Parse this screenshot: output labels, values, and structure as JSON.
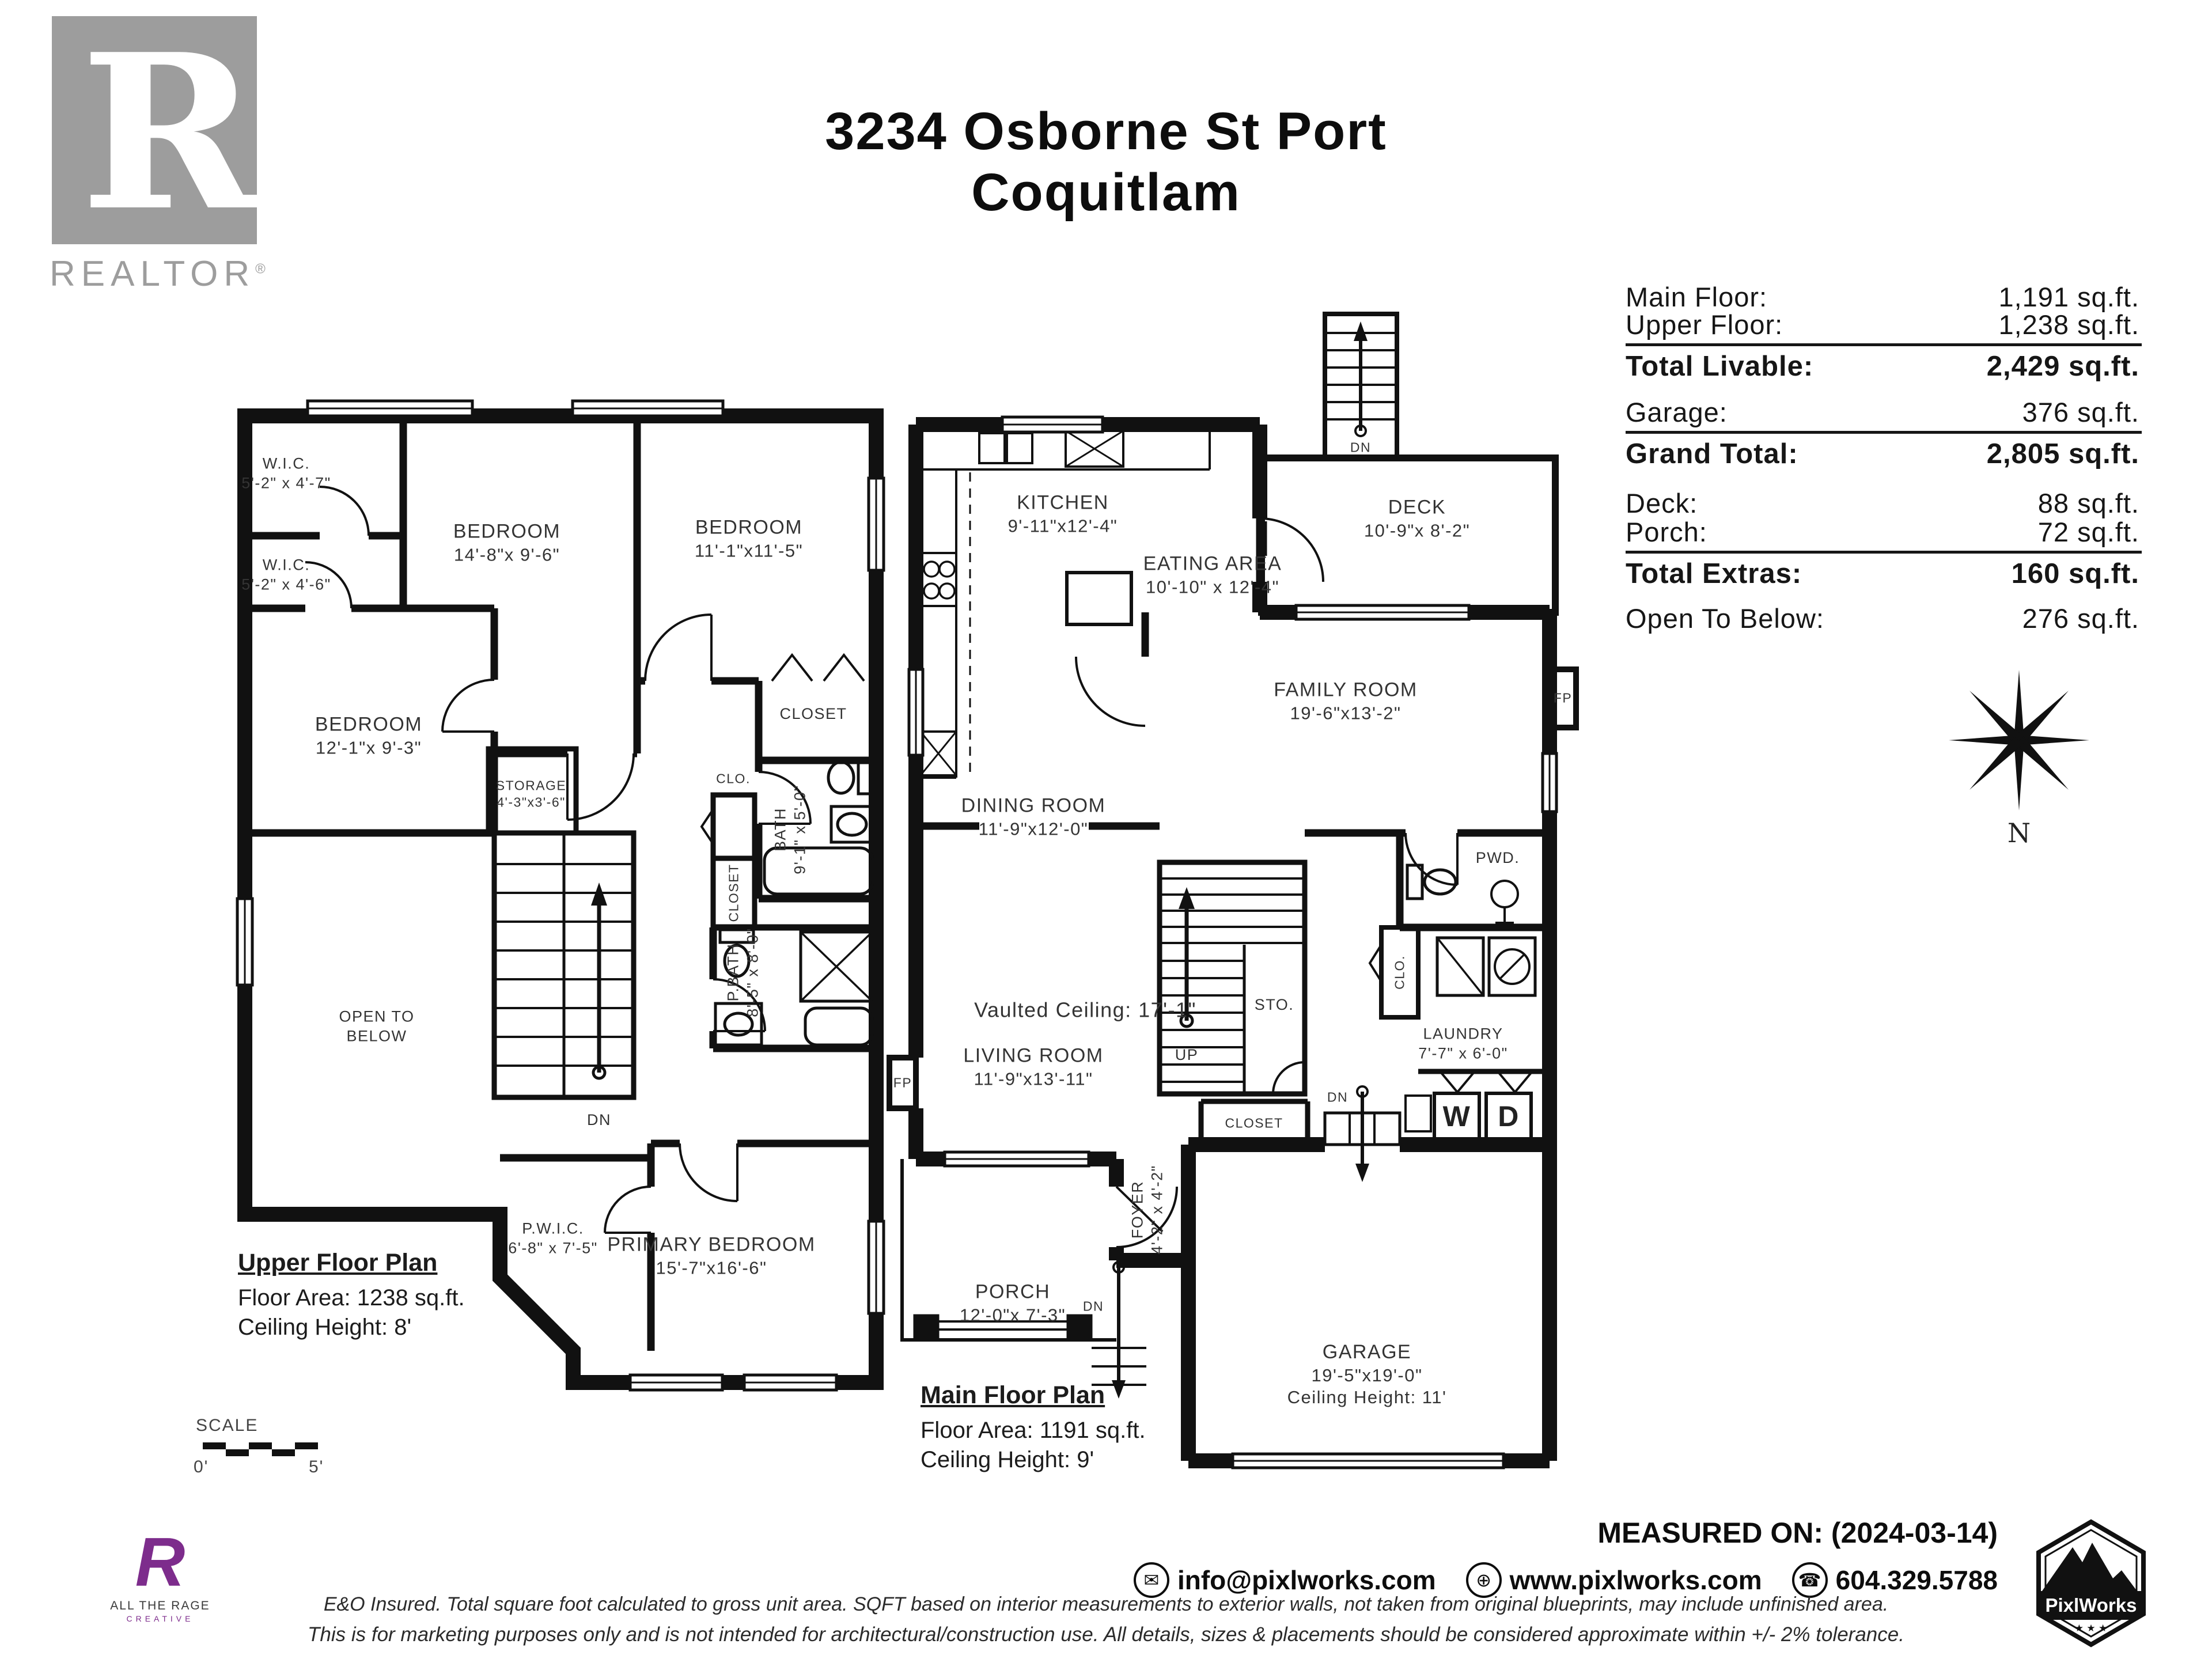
{
  "header": {
    "title_line1": "3234 Osborne St Port",
    "title_line2": "Coquitlam"
  },
  "realtor_logo": {
    "letter": "R",
    "wordmark": "REALTOR",
    "registered": "®"
  },
  "area_table": {
    "rows": [
      {
        "label": "Main Floor:",
        "value": "1,191 sq.ft."
      },
      {
        "label": "Upper Floor:",
        "value": "1,238 sq.ft."
      },
      {
        "label": "Total Livable:",
        "value": "2,429 sq.ft."
      },
      {
        "label": "Garage:",
        "value": "376 sq.ft."
      },
      {
        "label": "Grand Total:",
        "value": "2,805 sq.ft."
      },
      {
        "label": "Deck:",
        "value": "88 sq.ft."
      },
      {
        "label": "Porch:",
        "value": "72 sq.ft."
      },
      {
        "label": "Total Extras:",
        "value": "160 sq.ft."
      },
      {
        "label": "Open To Below:",
        "value": "276 sq.ft."
      }
    ]
  },
  "compass": {
    "north": "N"
  },
  "upper_plan": {
    "title": "Upper Floor Plan",
    "floor_area": "Floor Area: 1238 sq.ft.",
    "ceiling": "Ceiling Height: 8'",
    "rooms": [
      {
        "name": "W.I.C.",
        "dims": "5'-2\" x 4'-7\""
      },
      {
        "name": "BEDROOM",
        "dims": "14'-8\"x 9'-6\""
      },
      {
        "name": "BEDROOM",
        "dims": "11'-1\"x11'-5\""
      },
      {
        "name": "W.I.C.",
        "dims": "5'-2\" x 4'-6\""
      },
      {
        "name": "BEDROOM",
        "dims": "12'-1\"x 9'-3\""
      },
      {
        "name": "STORAGE",
        "dims": "4'-3\"x3'-6\""
      },
      {
        "name": "CLOSET"
      },
      {
        "name": "BATH",
        "dims": "9'-1\" x 5'-0\""
      },
      {
        "name": "CLO."
      },
      {
        "name": "CLOSET"
      },
      {
        "name": "OPEN TO",
        "dims": "BELOW"
      },
      {
        "name": "DN"
      },
      {
        "name": "P.BATH",
        "dims": "8'-5\" x 8'-0\""
      },
      {
        "name": "P.W.I.C.",
        "dims": "6'-8\" x 7'-5\""
      },
      {
        "name": "PRIMARY BEDROOM",
        "dims": "15'-7\"x16'-6\""
      }
    ]
  },
  "main_plan": {
    "title": "Main Floor Plan",
    "floor_area": "Floor Area: 1191 sq.ft.",
    "ceiling": "Ceiling Height: 9'",
    "rooms": [
      {
        "name": "KITCHEN",
        "dims": "9'-11\"x12'-4\""
      },
      {
        "name": "EATING AREA",
        "dims": "10'-10\" x 12'-4\""
      },
      {
        "name": "DECK",
        "dims": "10'-9\"x 8'-2\""
      },
      {
        "name": "DN"
      },
      {
        "name": "FAMILY ROOM",
        "dims": "19'-6\"x13'-2\""
      },
      {
        "name": "DINING ROOM",
        "dims": "11'-9\"x12'-0\""
      },
      {
        "name": "Vaulted Ceiling: 17'-1\""
      },
      {
        "name": "LIVING ROOM",
        "dims": "11'-9\"x13'-11\""
      },
      {
        "name": "STO."
      },
      {
        "name": "UP"
      },
      {
        "name": "PWD."
      },
      {
        "name": "CLO."
      },
      {
        "name": "LAUNDRY",
        "dims": "7'-7\" x 6'-0\""
      },
      {
        "name": "W"
      },
      {
        "name": "D"
      },
      {
        "name": "CLOSET"
      },
      {
        "name": "DN"
      },
      {
        "name": "FOYER",
        "dims": "4'-2\" x 4'-2\""
      },
      {
        "name": "PORCH",
        "dims": "12'-0\"x 7'-3\""
      },
      {
        "name": "DN"
      },
      {
        "name": "GARAGE",
        "dims": "19'-5\"x19'-0\"",
        "extra": "Ceiling Height: 11'"
      },
      {
        "name": "FP"
      },
      {
        "name": "FP"
      }
    ]
  },
  "scale_bar": {
    "label": "SCALE",
    "start": "0'",
    "end": "5'"
  },
  "footer": {
    "measured_on": "MEASURED ON: (2024-03-14)",
    "email": "info@pixlworks.com",
    "website": "www.pixlworks.com",
    "phone": "604.329.5788",
    "icons": {
      "email": "✉",
      "web": "⊕",
      "phone": "☎"
    },
    "disclaimer1": "E&O Insured.  Total square foot calculated to gross unit area. SQFT based on interior measurements to exterior walls, not taken from original blueprints, may include unfinished area.",
    "disclaimer2": "This is for marketing purposes only and is not intended for architectural/construction use.  All details, sizes & placements should be considered approximate within +/- 2%  tolerance."
  },
  "logos": {
    "atr": {
      "mark": "R",
      "line1": "ALL THE RAGE",
      "line2": "CREATIVE"
    },
    "pixlworks": {
      "name": "PixlWorks",
      "stars": "★ ★ ★"
    }
  }
}
